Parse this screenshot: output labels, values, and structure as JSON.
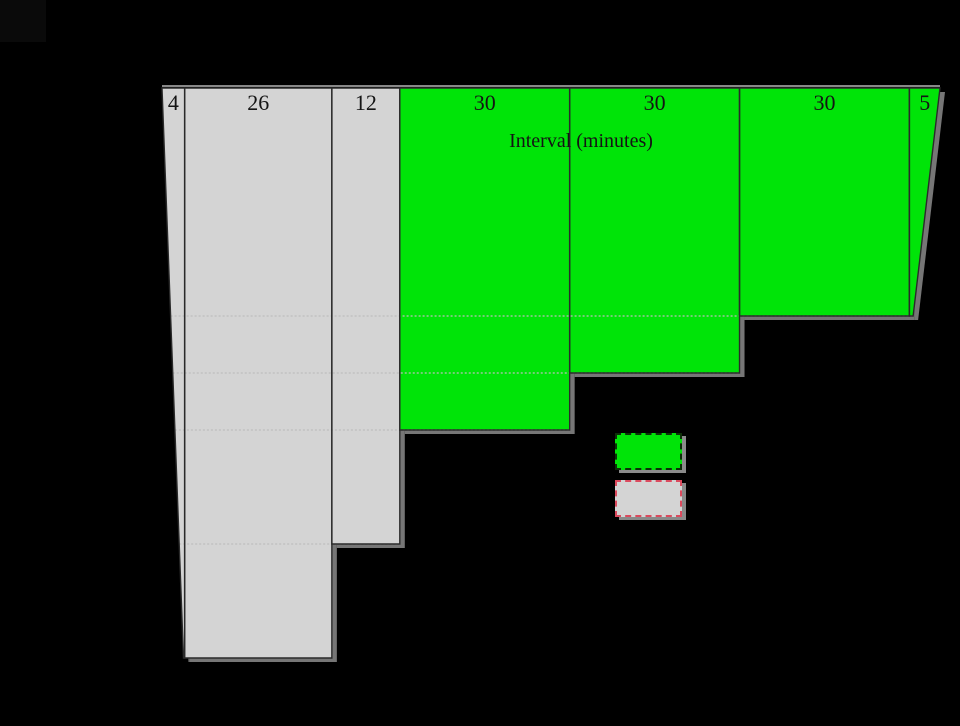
{
  "page": {
    "background": "#000000",
    "corner_artifact_color": "#0a0a0a"
  },
  "chart_data": {
    "type": "bar",
    "subtype": "histogram-hanging-from-top-axis",
    "title": "Interval (minutes)",
    "xlabel": "Interval (minutes)",
    "x_total_minutes": 137,
    "categories": [
      "4",
      "26",
      "12",
      "30",
      "30",
      "30",
      "5"
    ],
    "bars": [
      {
        "label": "4",
        "width_minutes": 4,
        "depth_units": 10,
        "color": "gray"
      },
      {
        "label": "26",
        "width_minutes": 26,
        "depth_units": 10,
        "color": "gray"
      },
      {
        "label": "12",
        "width_minutes": 12,
        "depth_units": 8,
        "color": "gray"
      },
      {
        "label": "30",
        "width_minutes": 30,
        "depth_units": 6,
        "color": "green"
      },
      {
        "label": "30",
        "width_minutes": 30,
        "depth_units": 5,
        "color": "green"
      },
      {
        "label": "30",
        "width_minutes": 30,
        "depth_units": 4,
        "color": "green"
      },
      {
        "label": "5",
        "width_minutes": 5,
        "depth_units": 4,
        "color": "green"
      }
    ],
    "leader_levels_units": [
      4,
      5,
      6,
      8
    ],
    "grid": "dotted-leader-lines-at-bar-ends",
    "colors": {
      "green": "#00e408",
      "gray": "#d4d4d4",
      "outline": "#2a2a2a",
      "shadow": "#767676",
      "leader": "#bdbdbd",
      "top_highlight": "#b5b5b5",
      "text": "#141414"
    },
    "render": {
      "origin_x": 162,
      "axis_y": 88,
      "px_per_minute": 5.662,
      "px_per_unit": 57,
      "left_top_x": 162,
      "left_bottom_x": 183.5,
      "left_bottom_y": 658,
      "right_top_x": 940,
      "right_bottom_x": 913,
      "right_bottom_y": 317,
      "shadow_dx": 5,
      "shadow_dy": 4,
      "label_y": 105,
      "label_font_px": 22
    }
  },
  "legend": {
    "items": [
      {
        "key": "green-swatch",
        "fill": "#00e408",
        "border_color": "#0d2f08"
      },
      {
        "key": "gray-swatch",
        "fill": "#d4d4d4",
        "border_color": "#dc4a5e"
      }
    ]
  }
}
